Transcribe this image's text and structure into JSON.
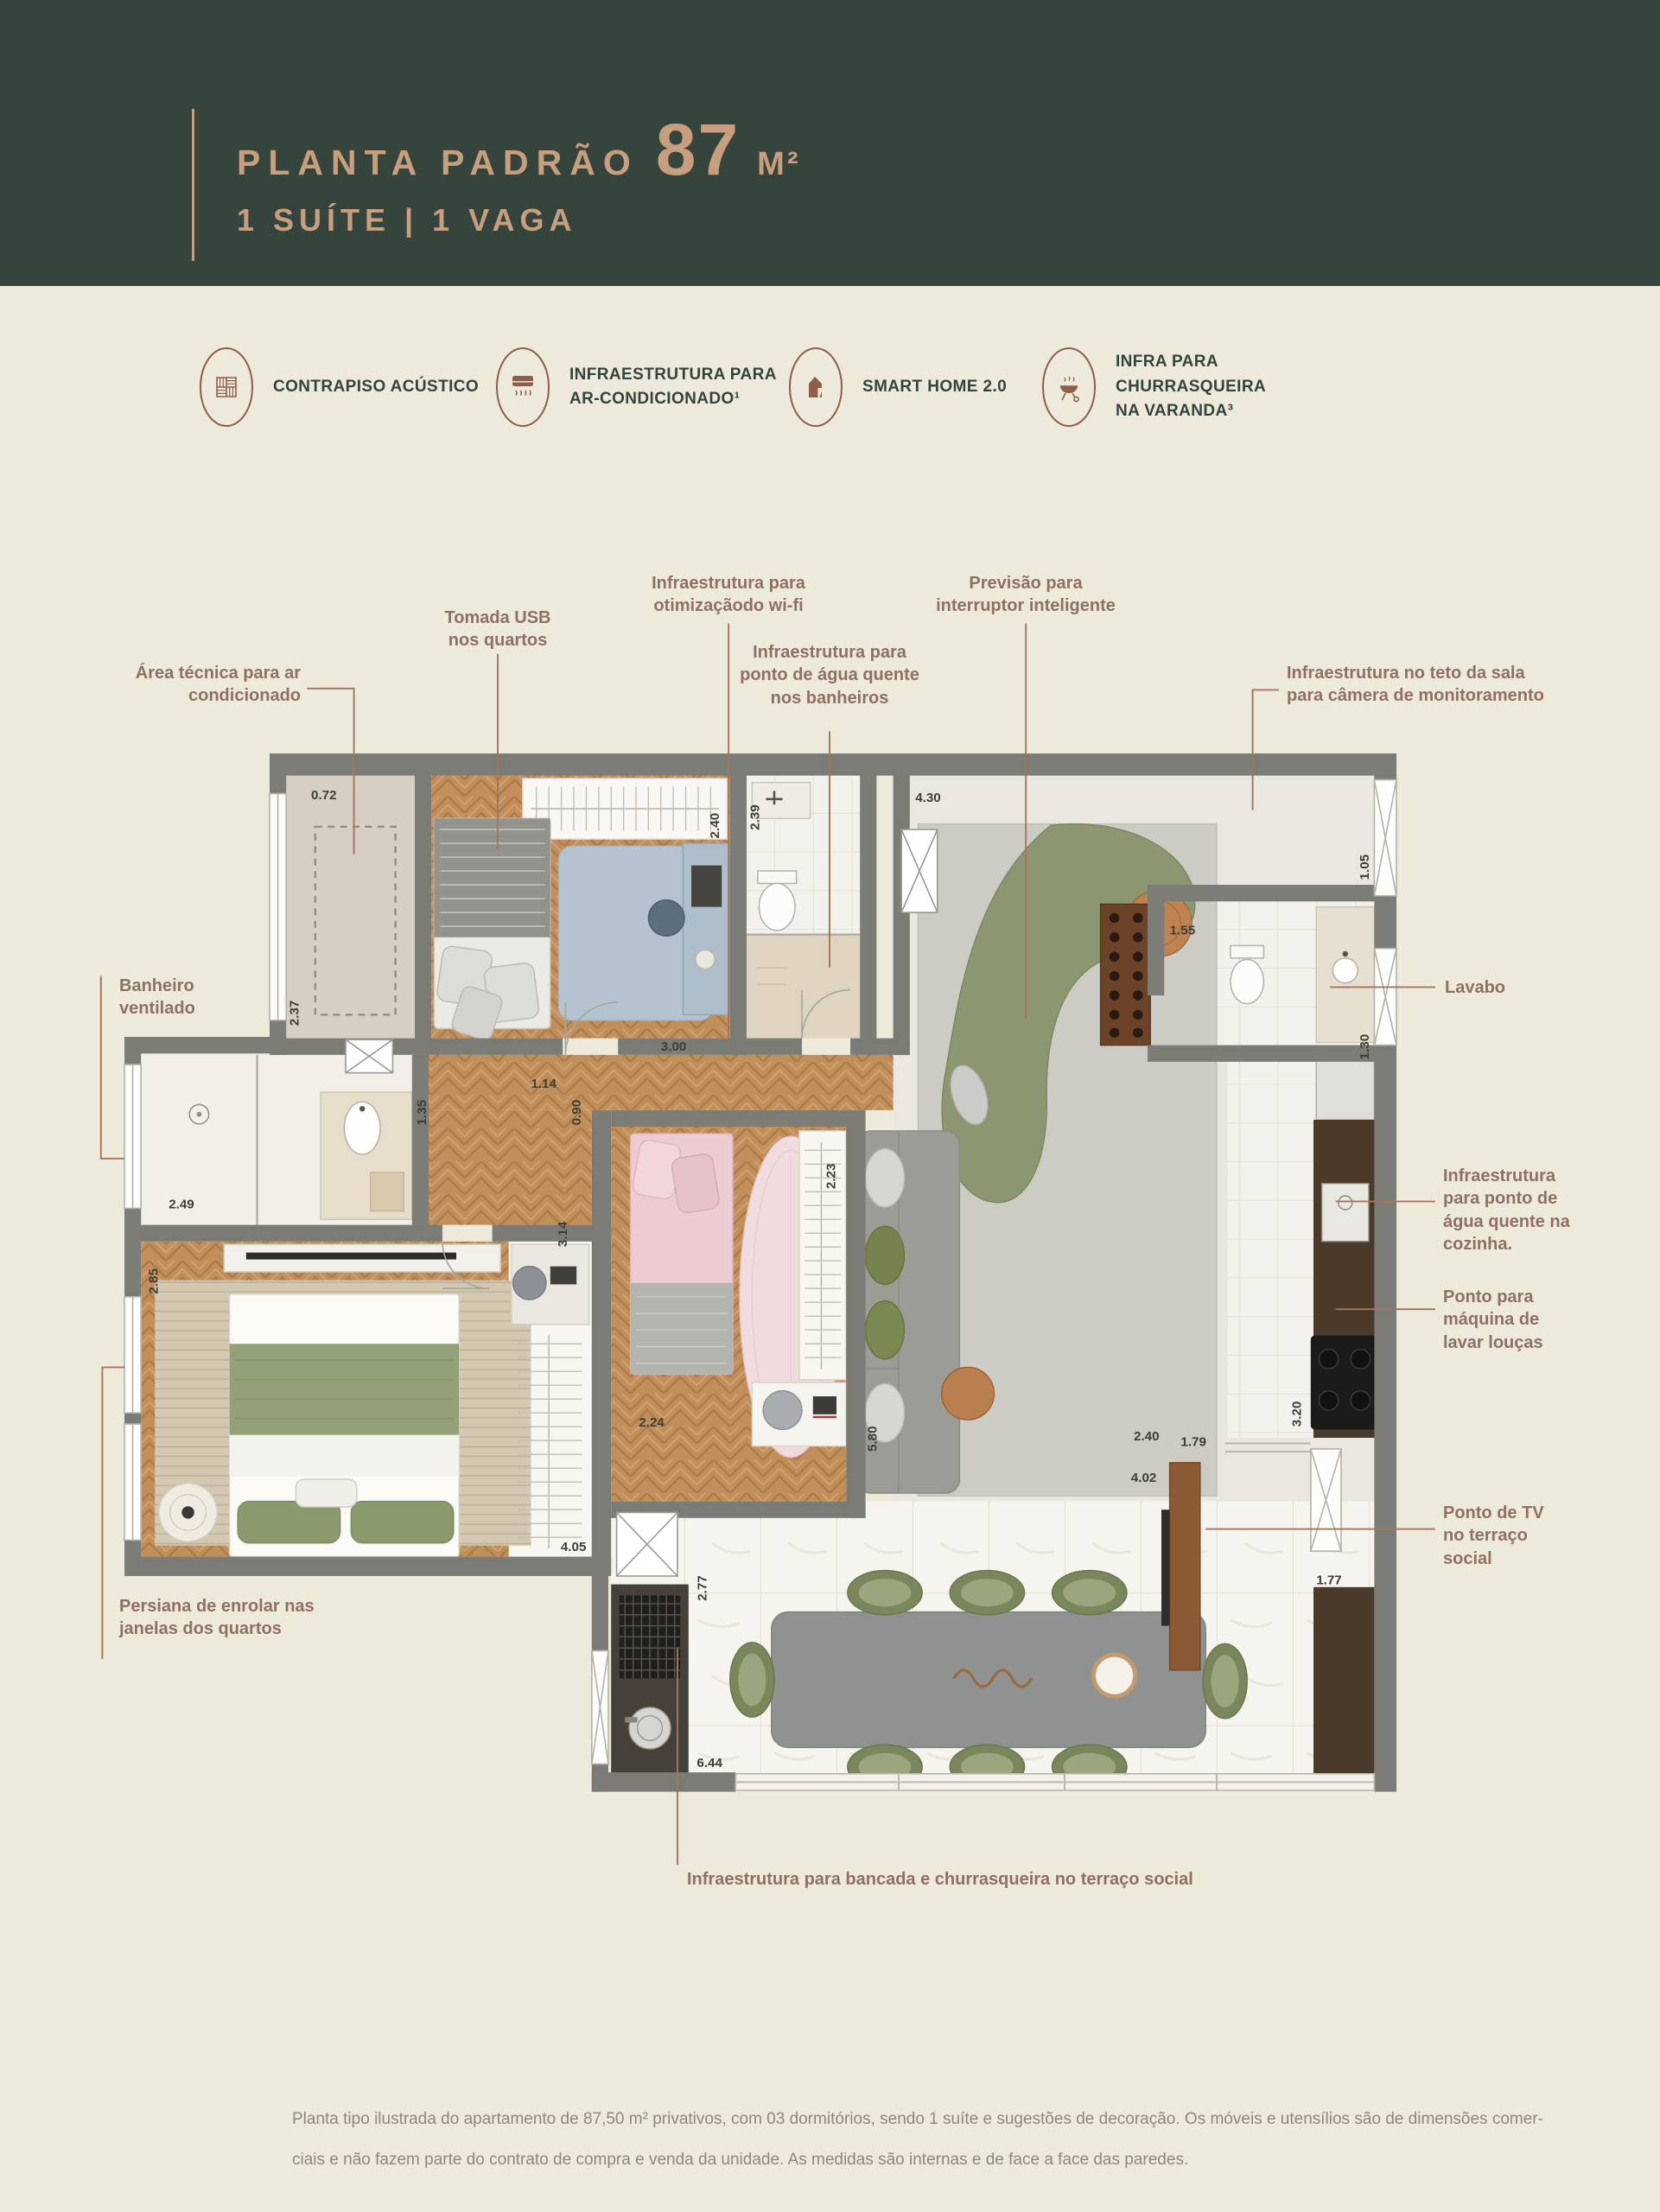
{
  "header": {
    "title": "PLANTA PADRÃO",
    "area_value": "87",
    "area_unit": "M²",
    "subtitle": "1 SUÍTE | 1 VAGA",
    "bg_color": "#35453e",
    "accent_color": "#c89f7e"
  },
  "features": [
    {
      "icon": "acoustic-subfloor-icon",
      "label": "CONTRAPISO ACÚSTICO"
    },
    {
      "icon": "air-conditioning-icon",
      "label": "INFRAESTRUTURA PARA\nAR-CONDICIONADO¹"
    },
    {
      "icon": "smart-home-icon",
      "label": "SMART HOME 2.0"
    },
    {
      "icon": "barbecue-icon",
      "label": "INFRA PARA CHURRASQUEIRA\nNA VARANDA³"
    }
  ],
  "callouts": {
    "tomada_usb": "Tomada USB\nnos quartos",
    "wifi": "Infraestrutura para\notimizaçãodo wi-fi",
    "interruptor": "Previsão para\ninterruptor inteligente",
    "agua_banheiros": "Infraestrutura para\nponto de água quente\nnos banheiros",
    "camera": "Infraestrutura no teto da sala\npara câmera de monitoramento",
    "area_tecnica": "Área técnica para ar\ncondicionado",
    "banheiro_ventilado": "Banheiro\nventilado",
    "lavabo": "Lavabo",
    "agua_cozinha": "Infraestrutura\npara ponto de\nágua quente na\ncozinha.",
    "maquina_loucas": "Ponto para\nmáquina de\nlavar louças",
    "ponto_tv": "Ponto de TV\nno terraço\nsocial",
    "persiana": "Persiana de enrolar nas\njanelas dos quartos",
    "bancada": "Infraestrutura para bancada e churrasqueira no terraço social"
  },
  "plan": {
    "dims": [
      "0.72",
      "2.40",
      "2.39",
      "4.30",
      "1.05",
      "1.55",
      "1.30",
      "2.37",
      "1.35",
      "3.00",
      "1.14",
      "0.90",
      "2.49",
      "2.85",
      "3.14",
      "2.23",
      "2.24",
      "5.80",
      "2.40",
      "1.79",
      "3.20",
      "4.02",
      "2.77",
      "4.05",
      "1.77",
      "6.44"
    ],
    "wall_color": "#7c7c76",
    "callout_color": "#8c7164"
  },
  "footer": {
    "disclaimer": "Planta tipo ilustrada do apartamento de 87,50 m² privativos, com 03 dormitórios, sendo 1 suíte e sugestões de decoração. Os móveis e utensílios são de dimensões comer-\nciais e não fazem parte do contrato de compra e venda da unidade. As medidas são internas e de face a face das paredes."
  }
}
